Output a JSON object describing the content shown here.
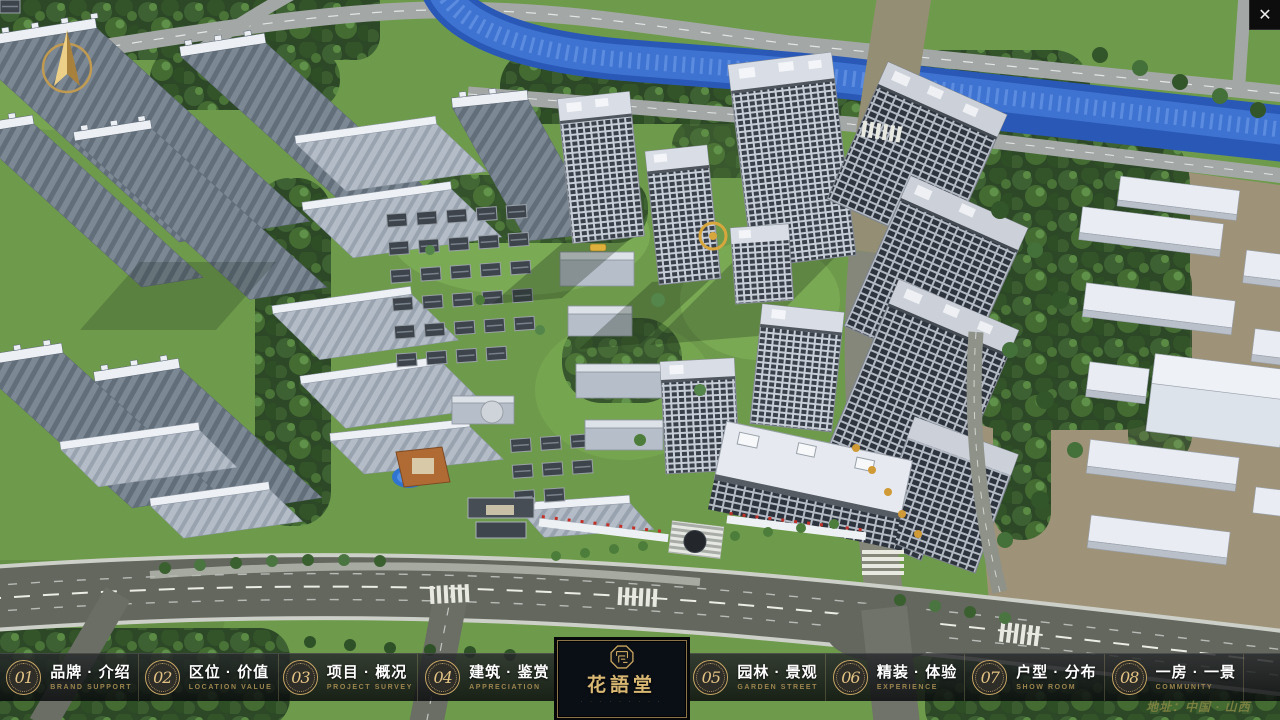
{
  "window": {
    "close_icon": "✕"
  },
  "overlay": {
    "compass_icon": "north-arrow-compass"
  },
  "nav": {
    "items": [
      {
        "num": "01",
        "zh": "品牌 · 介绍",
        "en": "BRAND SUPPORT"
      },
      {
        "num": "02",
        "zh": "区位 · 价值",
        "en": "LOCATION VALUE"
      },
      {
        "num": "03",
        "zh": "项目 · 概况",
        "en": "PROJECT SURVEY"
      },
      {
        "num": "04",
        "zh": "建筑 · 鉴赏",
        "en": "APPRECIATION"
      },
      {
        "num": "05",
        "zh": "园林 · 景观",
        "en": "GARDEN STREET"
      },
      {
        "num": "06",
        "zh": "精装 · 体验",
        "en": "EXPERIENCE"
      },
      {
        "num": "07",
        "zh": "户型 · 分布",
        "en": "SHOW ROOM"
      },
      {
        "num": "08",
        "zh": "一房 · 一景",
        "en": "COMMUNITY"
      }
    ]
  },
  "logo": {
    "name": "花語堂",
    "tagline": "· · · · · · · · ·"
  },
  "footer": {
    "address": "地址：中国 · 山西"
  },
  "colors": {
    "accent_gold": "#c9a86a",
    "nav_bg": "rgba(10,12,15,0.8)",
    "river_blue": "#2f63c4",
    "panel_bg": "#0a0e15",
    "ground_green": "#6e9a4b"
  }
}
